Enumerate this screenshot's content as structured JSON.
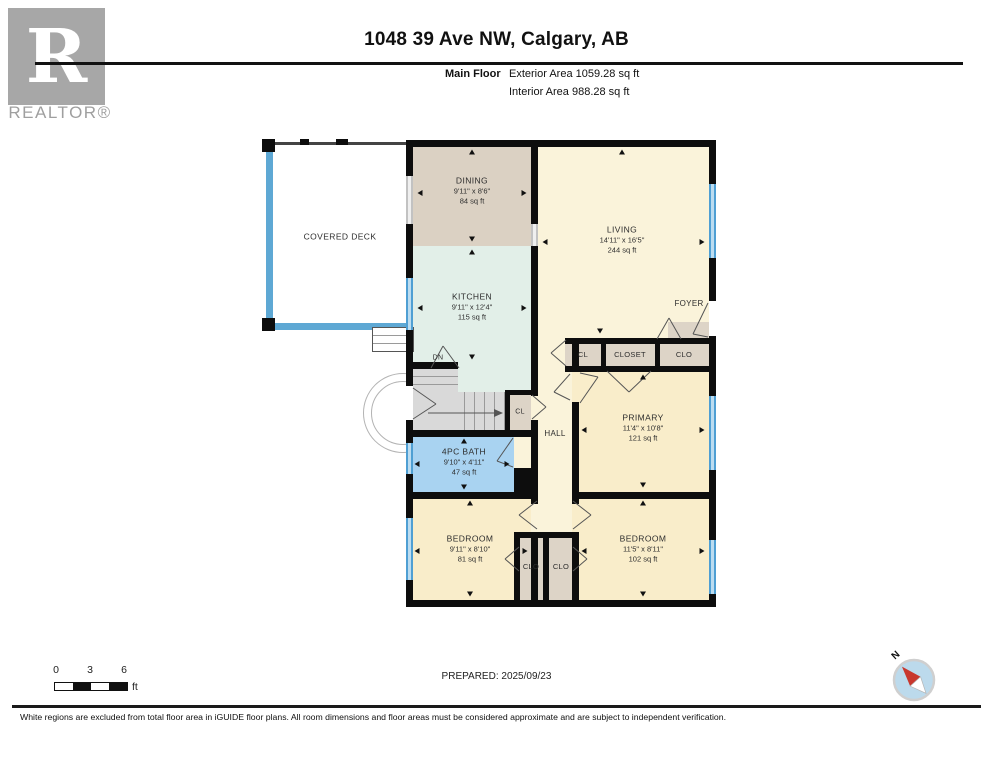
{
  "header": {
    "logo_letter": "R",
    "logo_text": "REALTOR®",
    "title": "1048 39 Ave NW, Calgary, AB",
    "floor_label": "Main Floor",
    "exterior_area": "Exterior Area 1059.28 sq ft",
    "interior_area": "Interior Area 988.28 sq ft"
  },
  "rooms": {
    "covered_deck": {
      "name": "COVERED DECK"
    },
    "dining": {
      "name": "DINING",
      "dims": "9'11\" x 8'6\"",
      "area": "84 sq ft"
    },
    "kitchen": {
      "name": "KITCHEN",
      "dims": "9'11\" x 12'4\"",
      "area": "115 sq ft"
    },
    "living": {
      "name": "LIVING",
      "dims": "14'11\" x 16'5\"",
      "area": "244 sq ft"
    },
    "foyer": {
      "name": "FOYER"
    },
    "hall": {
      "name": "HALL"
    },
    "primary": {
      "name": "PRIMARY",
      "dims": "11'4\" x 10'8\"",
      "area": "121 sq ft"
    },
    "bath": {
      "name": "4PC BATH",
      "dims": "9'10\" x 4'11\"",
      "area": "47 sq ft"
    },
    "bedroom_left": {
      "name": "BEDROOM",
      "dims": "9'11\" x 8'10\"",
      "area": "81 sq ft"
    },
    "bedroom_right": {
      "name": "BEDROOM",
      "dims": "11'5\" x 8'11\"",
      "area": "102 sq ft"
    },
    "stairs_label": "DN",
    "closet_row_cl": "CL",
    "closet_row_main": "CLOSET",
    "closet_row_clo": "CLO",
    "closet_stair": "CL",
    "closet_bottom_left": "CLO",
    "closet_bottom_right": "CLO"
  },
  "footer": {
    "scale": {
      "tick0": "0",
      "tick3": "3",
      "tick6": "6",
      "unit": "ft"
    },
    "prepared": "PREPARED: 2025/09/23",
    "compass_label": "N",
    "disclaimer": "White regions are excluded from total floor area in iGUIDE floor plans. All room dimensions and floor areas must be considered approximate and are subject to independent verification."
  },
  "colors": {
    "wall": "#0d0d0d",
    "window_blue": "#4f9fd3",
    "deck_blue": "#5ea8d4",
    "living_cream": "#faf3da",
    "bedroom_cream": "#f9edca",
    "kitchen_mint": "#e2efe8",
    "dining_beige": "#dbd1c3",
    "closet_taupe": "#ddd4c7",
    "stairs_gray": "#d9d9d9",
    "bath_blue": "#a9d3f1",
    "logo_gray": "#a7a7a7",
    "compass_red": "#c8372d",
    "compass_fill": "#bcdaec"
  }
}
